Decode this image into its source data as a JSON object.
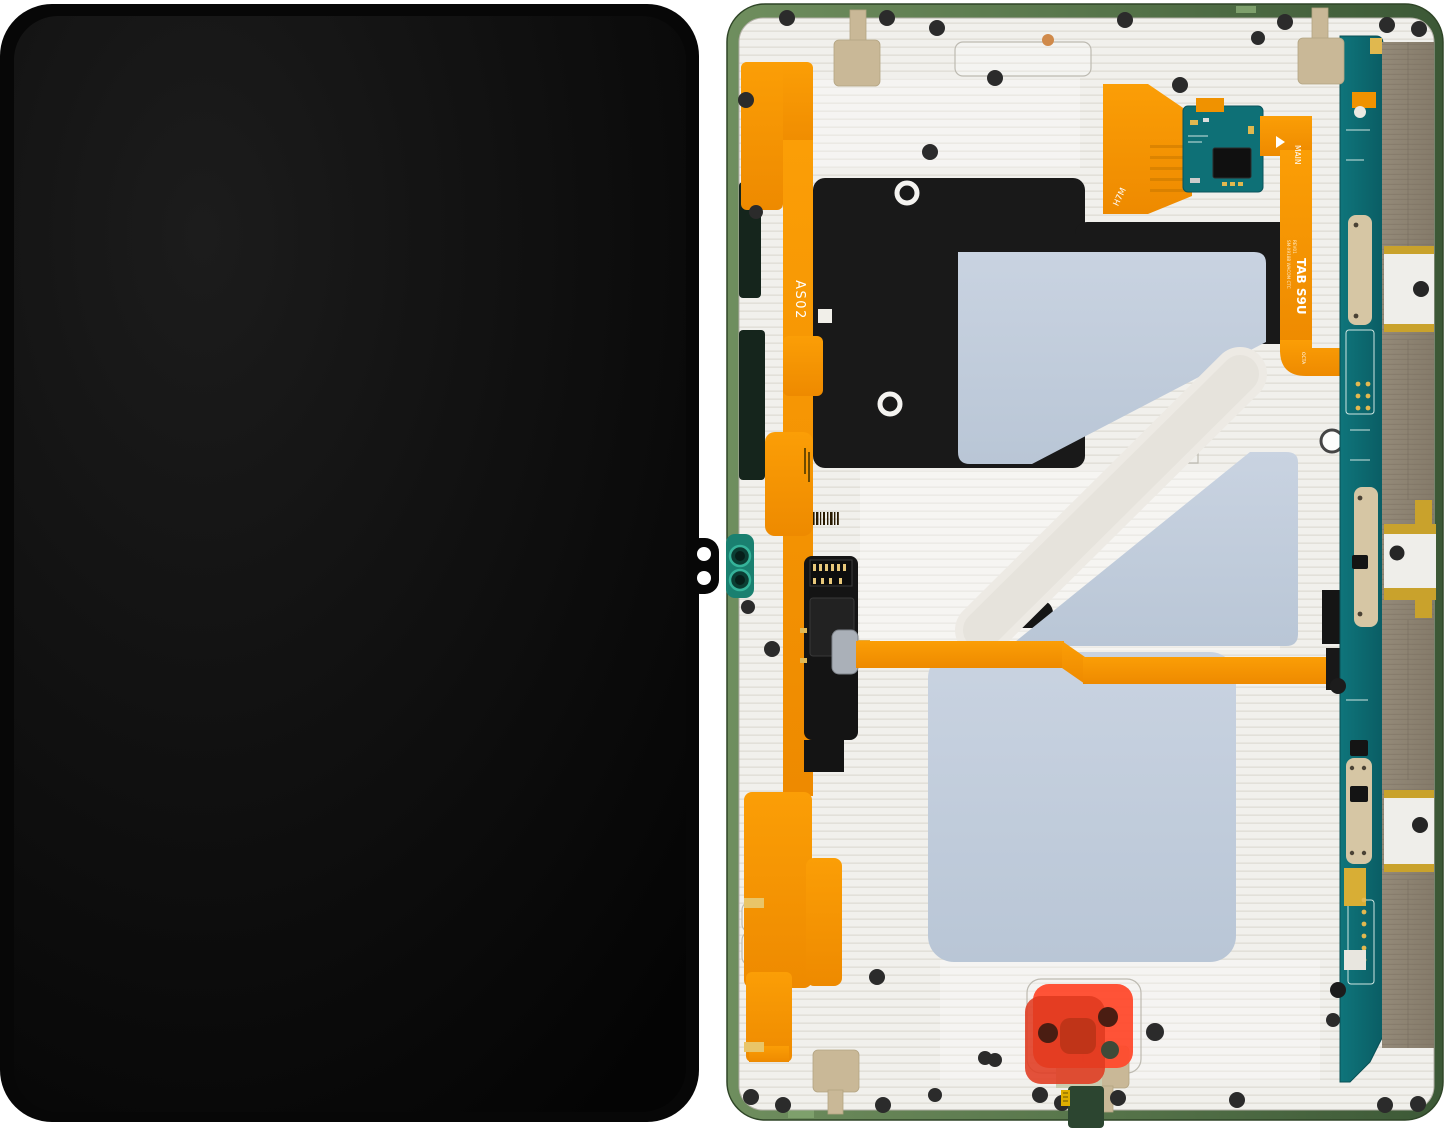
{
  "photo": {
    "labels": {
      "flex_left": "AS02",
      "flex_model": "TAB S9U",
      "flex_model_detail_1": "SM-X918B WACOM CTC",
      "flex_model_detail_2": "REV01",
      "connector_main": "MAIN",
      "connector_octa": "OCTA",
      "flex_top": "H7M"
    },
    "colors": {
      "screen_black": "#0a0a0a",
      "frame_green": "#5c7b50",
      "laminate_white": "#f0efec",
      "flex_orange": "#f69500",
      "pcb_teal": "#0d6a70",
      "thermal_pad_blue": "#c3cedd",
      "graphite_black": "#191919",
      "shield_khaki": "#8b8170",
      "antenna_beige": "#c9b897",
      "pull_tab_red": "#ff4a2c",
      "contact_gold": "#d8ae35"
    }
  }
}
